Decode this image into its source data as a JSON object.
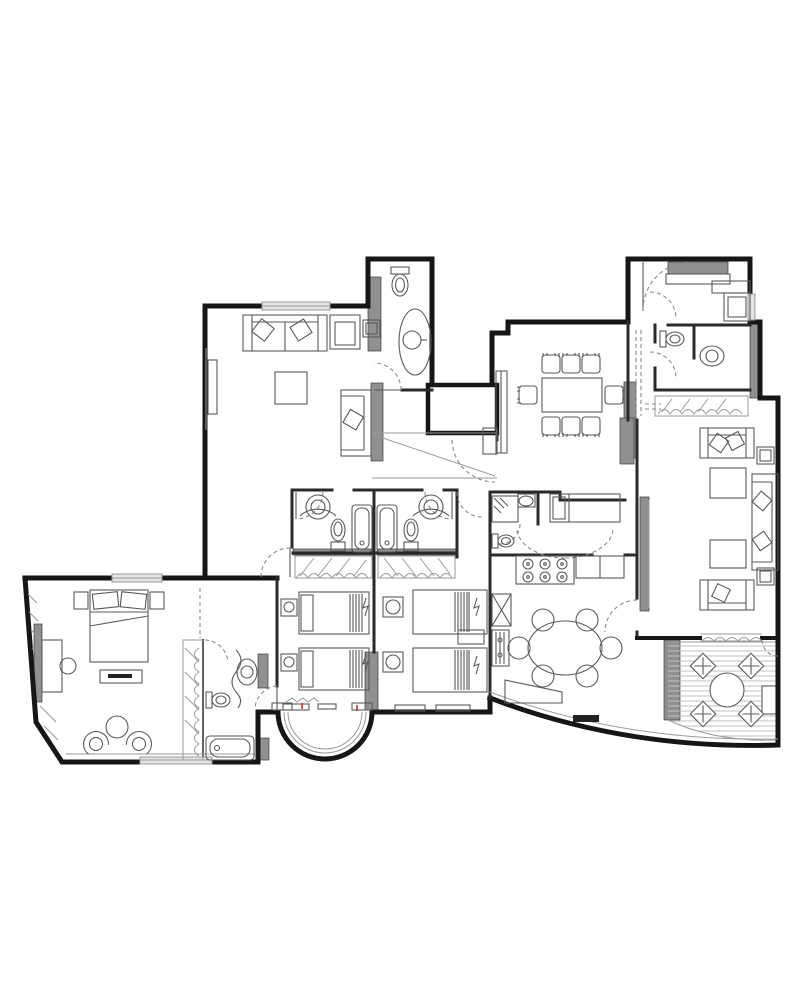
{
  "plan": {
    "type": "architectural-floor-plan",
    "style": "black-and-white top-down apartment blueprint, no text labels",
    "colors": {
      "wall": "#161616",
      "interior_wall": "#2a2a2a",
      "poche": "#909090",
      "furniture": "#5a5a5a",
      "light": "#9a9a9a",
      "window": "#e3e3e3",
      "dashed": "#8a8a8a",
      "deck": "#c2c2c2",
      "accent_red": "#c0392b"
    },
    "rooms": [
      {
        "name": "living-room",
        "furniture": [
          "sofa",
          "armchair",
          "side-table",
          "coffee-table",
          "chaise-longue",
          "tv-cabinet",
          "window"
        ]
      },
      {
        "name": "guest-bathroom",
        "furniture": [
          "toilet",
          "vanity-counter-sink"
        ]
      },
      {
        "name": "hallway",
        "furniture": [
          "closet-band",
          "structural-core"
        ]
      },
      {
        "name": "dining-room",
        "furniture": [
          "dining-table",
          "eight-chairs",
          "sideboard",
          "cabinet"
        ]
      },
      {
        "name": "entry-hall",
        "furniture": [
          "entry-door",
          "wall-cabinet",
          "console-counter",
          "wardrobe"
        ]
      },
      {
        "name": "entry-bathroom",
        "furniture": [
          "toilet",
          "sink"
        ]
      },
      {
        "name": "family-room",
        "furniture": [
          "sofa",
          "sofa",
          "chaise-sofa",
          "coffee-table",
          "coffee-table",
          "side-table",
          "side-table",
          "tv-cabinet",
          "curtain-window"
        ]
      },
      {
        "name": "kids-bathroom-left",
        "furniture": [
          "round-sink",
          "toilet",
          "bathtub",
          "wardrobe"
        ]
      },
      {
        "name": "kids-bathroom-right",
        "furniture": [
          "round-sink",
          "toilet",
          "bathtub",
          "wardrobe"
        ]
      },
      {
        "name": "bedroom-left",
        "furniture": [
          "single-bed",
          "single-bed",
          "nightstand-lamp",
          "nightstand-lamp",
          "window-sill"
        ]
      },
      {
        "name": "bedroom-right",
        "furniture": [
          "single-bed",
          "single-bed",
          "nightstand-lamp",
          "nightstand-lamp",
          "side-table"
        ]
      },
      {
        "name": "maid-room",
        "furniture": [
          "bed",
          "shower",
          "toilet",
          "sink"
        ]
      },
      {
        "name": "kitchen-breakfast",
        "furniture": [
          "six-burner-stove",
          "counter",
          "sink",
          "dishwasher",
          "angled-island",
          "oval-table",
          "six-chairs",
          "curved-window-wall"
        ]
      },
      {
        "name": "master-bedroom",
        "furniture": [
          "double-bed",
          "nightstand",
          "nightstand",
          "bench",
          "desk",
          "chair",
          "armchair",
          "armchair",
          "round-table",
          "tv-panel",
          "wardrobe",
          "windows"
        ]
      },
      {
        "name": "master-bathroom",
        "furniture": [
          "vanity-sink",
          "toilet",
          "bathtub"
        ]
      },
      {
        "name": "bay-window",
        "furniture": [
          "curved-glazing",
          "sills"
        ]
      },
      {
        "name": "terrace",
        "furniture": [
          "round-table",
          "four-chairs",
          "deck-floor"
        ]
      }
    ]
  }
}
